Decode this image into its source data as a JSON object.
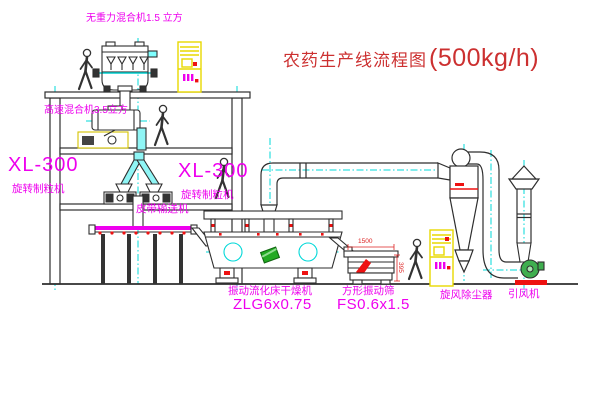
{
  "title": {
    "text_cn": "农药生产线流程图",
    "capacity": "(500kg/h)"
  },
  "labels": {
    "mixer_top": "无重力混合机1.5 立方",
    "mixer_mid": "高速混合机3.5立方",
    "granulator_left_model": "XL-300",
    "granulator_left_name": "旋转制粒机",
    "granulator_right_model": "XL-300",
    "granulator_right_name": "旋转制粒机",
    "belt_conveyor": "皮带输送机",
    "dryer_name": "振动流化床干燥机",
    "dryer_model": "ZLG6x0.75",
    "sieve_name": "方形振动筛",
    "sieve_model": "FS0.6x1.5",
    "cyclone": "旋风除尘器",
    "fan": "引风机"
  },
  "dimensions": {
    "sieve_length": "1500",
    "sieve_height": "395"
  },
  "colors": {
    "label_magenta": "#ee00ee",
    "title_red": "#cc3030",
    "detail_red": "#ee1111",
    "cabinet_yellow": "#e8d800",
    "centerline_cyan": "#00d8d8",
    "logo_green": "#22aa22",
    "line_dark": "#2e2e2e"
  },
  "icons": {
    "worker_figure": "walking-person-outline",
    "rain_cap": "stack-rain-cap",
    "crosshair": "vibration-crosshair"
  }
}
